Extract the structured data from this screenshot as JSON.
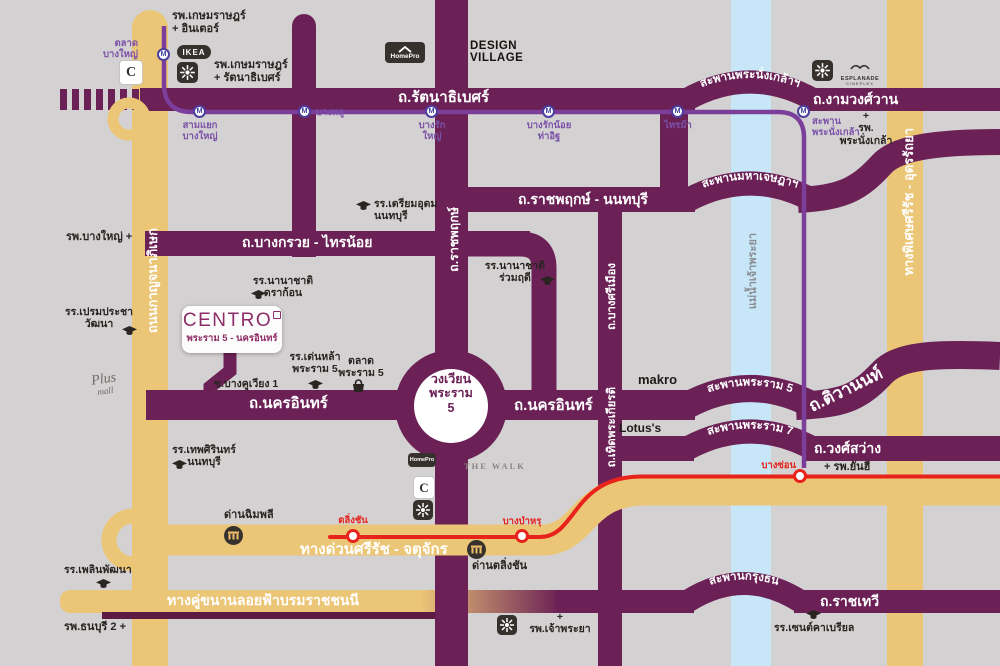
{
  "project": {
    "brand": "CENTRO",
    "subtitle": "พระราม 5 - นครอินทร์"
  },
  "roundabout": {
    "label": "วงเวียน\nพระราม\n5"
  },
  "roads": {
    "rattanathibet": "ถ.รัตนาธิเบศร์",
    "ngamwongwan": "ถ.งามวงศ์วาน",
    "ratchaphruek_nonthaburi": "ถ.ราชพฤกษ์ - นนทบุรี",
    "bang_kruai_sai_noi": "ถ.บางกรวย - ไทรน้อย",
    "nakhon_in_west": "ถ.นครอินทร์",
    "nakhon_in_east": "ถ.นครอินทร์",
    "wong_sawang": "ถ.วงศ์สว่าง",
    "ratchathewi": "ถ.ราชเทวี",
    "tiwanon": "ถ.ติวานนท์",
    "ratchaphruek_vertical": "ถ.ราชพฤกษ์",
    "bang_si_mueang": "ถ.บางศรีเมือง",
    "thoet_phrakiat": "ถ.เทิดพระเกียรติ",
    "kanchanaphisek": "ถนนกาญจนาภิเษก",
    "si_rat_udon_ratthaya": "ทางพิเศษศรีรัช - อุดรรัถยา",
    "si_rat_chatuchak": "ทางด่วนศรีรัช  -  จตุจักร",
    "borommaratchachonnani": "ทางคู่ขนานลอยฟ้าบรมราชชนนี",
    "soi_bang_khu_wiang": "ซ.บางคูเวียง 1"
  },
  "bridges": {
    "phra_nang_klao": "สะพานพระนั่งเกล้าฯ",
    "maha_chetsada": "สะพานมหาเจษฎาฯ",
    "rama5": "สะพานพระราม 5",
    "rama7": "สะพานพระราม 7",
    "krung_thon": "สะพานกรุงธน"
  },
  "river": {
    "name": "แม่น้ำเจ้าพระยา"
  },
  "mrt": {
    "logo_letter": "M",
    "stations": {
      "talad_bang_yai": "ตลาด\nบางใหญ่",
      "sam_yaek_bang_yai": "สามแยก\nบางใหญ่",
      "bang_phlu": "บางพลู",
      "bang_rak_yai": "บางรัก\nใหญ่",
      "bang_rak_noi_tha_it": "บางรักน้อย\nท่าอิฐ",
      "sai_ma": "ไทรม้า",
      "saphan_phra_nang_klao": "สะพาน\nพระนั่งเกล้า"
    }
  },
  "expressway": {
    "stations": {
      "taling_chan": "ตลิ่งชัน",
      "bang_bamru": "บางบำหรุ",
      "bang_son": "บางซ่อน"
    },
    "tolls": {
      "chimphli": "ด่านฉิมพลี",
      "taling_chan": "ด่านตลิ่งชัน"
    }
  },
  "places": {
    "kasemrad_inter": "รพ.เกษมราษฎร์\n+ อินเตอร์",
    "kasemrad_rattanathibet": "รพ.เกษมราษฎร์\n+ รัตนาธิเบศร์",
    "design_village": "DESIGN\nVILLAGE",
    "phra_nang_klao_hospital": "+\nรพ.\nพระนั่งเกล้า",
    "bang_yai_hospital": "รพ.บางใหญ่ +",
    "triam_udom_school": "รร.เตรียมอุดม\nนนทบุรี",
    "ruamrudee_school": "รร.นานาชาติ\nร่วมฤดี",
    "dragon_school": "รร.นานาชาติ\nดราก้อน",
    "prem_pracha_school": "รร.เปรมประชา\nวัฒนา",
    "denla_school": "รร.เด่นหล้า\nพระราม 5",
    "talad_rama5": "ตลาด\nพระราม 5",
    "makro": "makro",
    "lotus": "Lotus's",
    "yanhee_hospital": "+ รพ.ยันฮี",
    "thep_sirin_school": "รร.เทพศิรินทร์\nนนทบุรี",
    "ploen_phatthana_school": "รร.เพลินพัฒนา",
    "thonburi2_hospital": "รพ.ธนบุรี 2 +",
    "chao_phraya_hospital": "+\nรพ.เจ้าพระยา",
    "st_gabriel_school": "รร.เซนต์คาเบรียล"
  },
  "logos": {
    "ikea": "IKEA",
    "homepro": "HomePro",
    "central_letter": "C",
    "esplanade": "ESPLANADE",
    "esplanade_sub": "CINEPLEX",
    "the_walk": "THE WALK",
    "plus_mall_line1": "Plus",
    "plus_mall_line2": "mall"
  },
  "colors": {
    "road_purple": "#6b2156",
    "road_yellow": "#ecc677",
    "mrt_purple": "#7b3f9b",
    "expressway_red": "#e8231c",
    "river_blue": "#c7e7f8",
    "background": "#d4d1d2",
    "station_label_purple": "#7b52a8",
    "centro_purple": "#8d2d68"
  }
}
